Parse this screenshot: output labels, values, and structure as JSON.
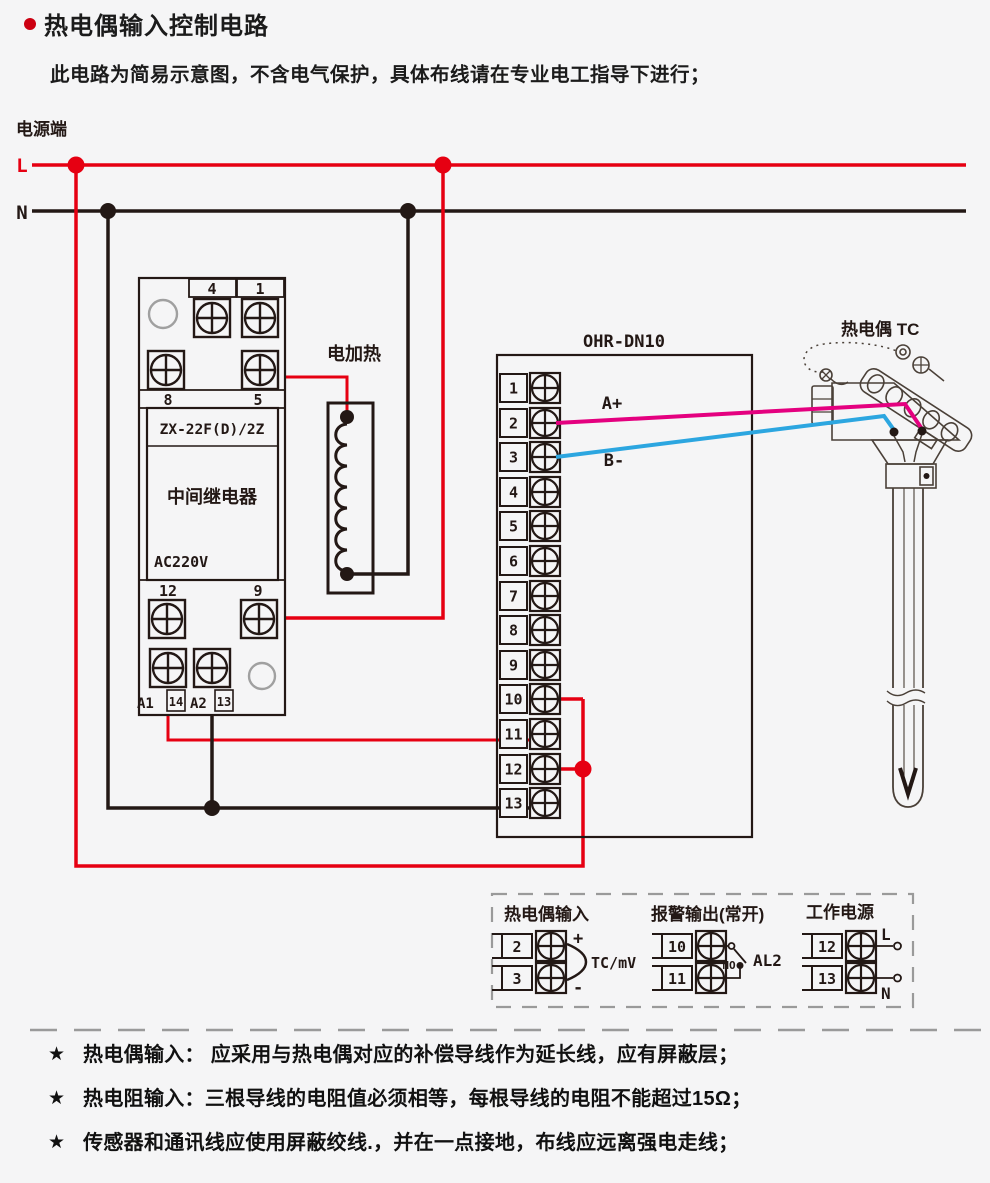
{
  "header": {
    "title": "热电偶输入控制电路",
    "subtitle": "此电路为简易示意图，不含电气保护，具体布线请在专业电工指导下进行；"
  },
  "power": {
    "section_label": "电源端",
    "live": "L",
    "neutral": "N"
  },
  "relay": {
    "model": "ZX-22F(D)/2Z",
    "name": "中间继电器",
    "voltage": "AC220V",
    "terminals": {
      "t4": "4",
      "t1": "1",
      "t8": "8",
      "t5": "5",
      "t12": "12",
      "t9": "9",
      "a1": "A1",
      "t14": "14",
      "a2": "A2",
      "t13": "13"
    }
  },
  "heater": {
    "label": "电加热"
  },
  "controller": {
    "model": "OHR-DN10",
    "terminals": [
      "1",
      "2",
      "3",
      "4",
      "5",
      "6",
      "7",
      "8",
      "9",
      "10",
      "11",
      "12",
      "13"
    ],
    "wire_a_label": "A+",
    "wire_b_label": "B-"
  },
  "thermocouple": {
    "label": "热电偶 TC"
  },
  "legend": {
    "tc_input": {
      "title": "热电偶输入",
      "t2": "2",
      "t3": "3",
      "plus": "+",
      "minus": "-",
      "signal": "TC/mV"
    },
    "alarm_output": {
      "title": "报警输出(常开)",
      "t10": "10",
      "t11": "11",
      "contact": "NO",
      "name": "AL2"
    },
    "work_power": {
      "title": "工作电源",
      "t12": "12",
      "t13": "13",
      "live": "L",
      "neutral": "N"
    }
  },
  "notes": [
    {
      "bullet": "★",
      "text": "热电偶输入： 应采用与热电偶对应的补偿导线作为延长线，应有屏蔽层；"
    },
    {
      "bullet": "★",
      "text": "热电阻输入：三根导线的电阻值必须相等，每根导线的电阻不能超过15Ω；"
    },
    {
      "bullet": "★",
      "text": "传感器和通讯线应使用屏蔽绞线.，并在一点接地，布线应远离强电走线；"
    }
  ],
  "colors": {
    "line_red": "#e60012",
    "line_black": "#231815",
    "wire_magenta": "#e4007f",
    "wire_blue": "#2ca6e0",
    "background": "#f5f5f6"
  }
}
